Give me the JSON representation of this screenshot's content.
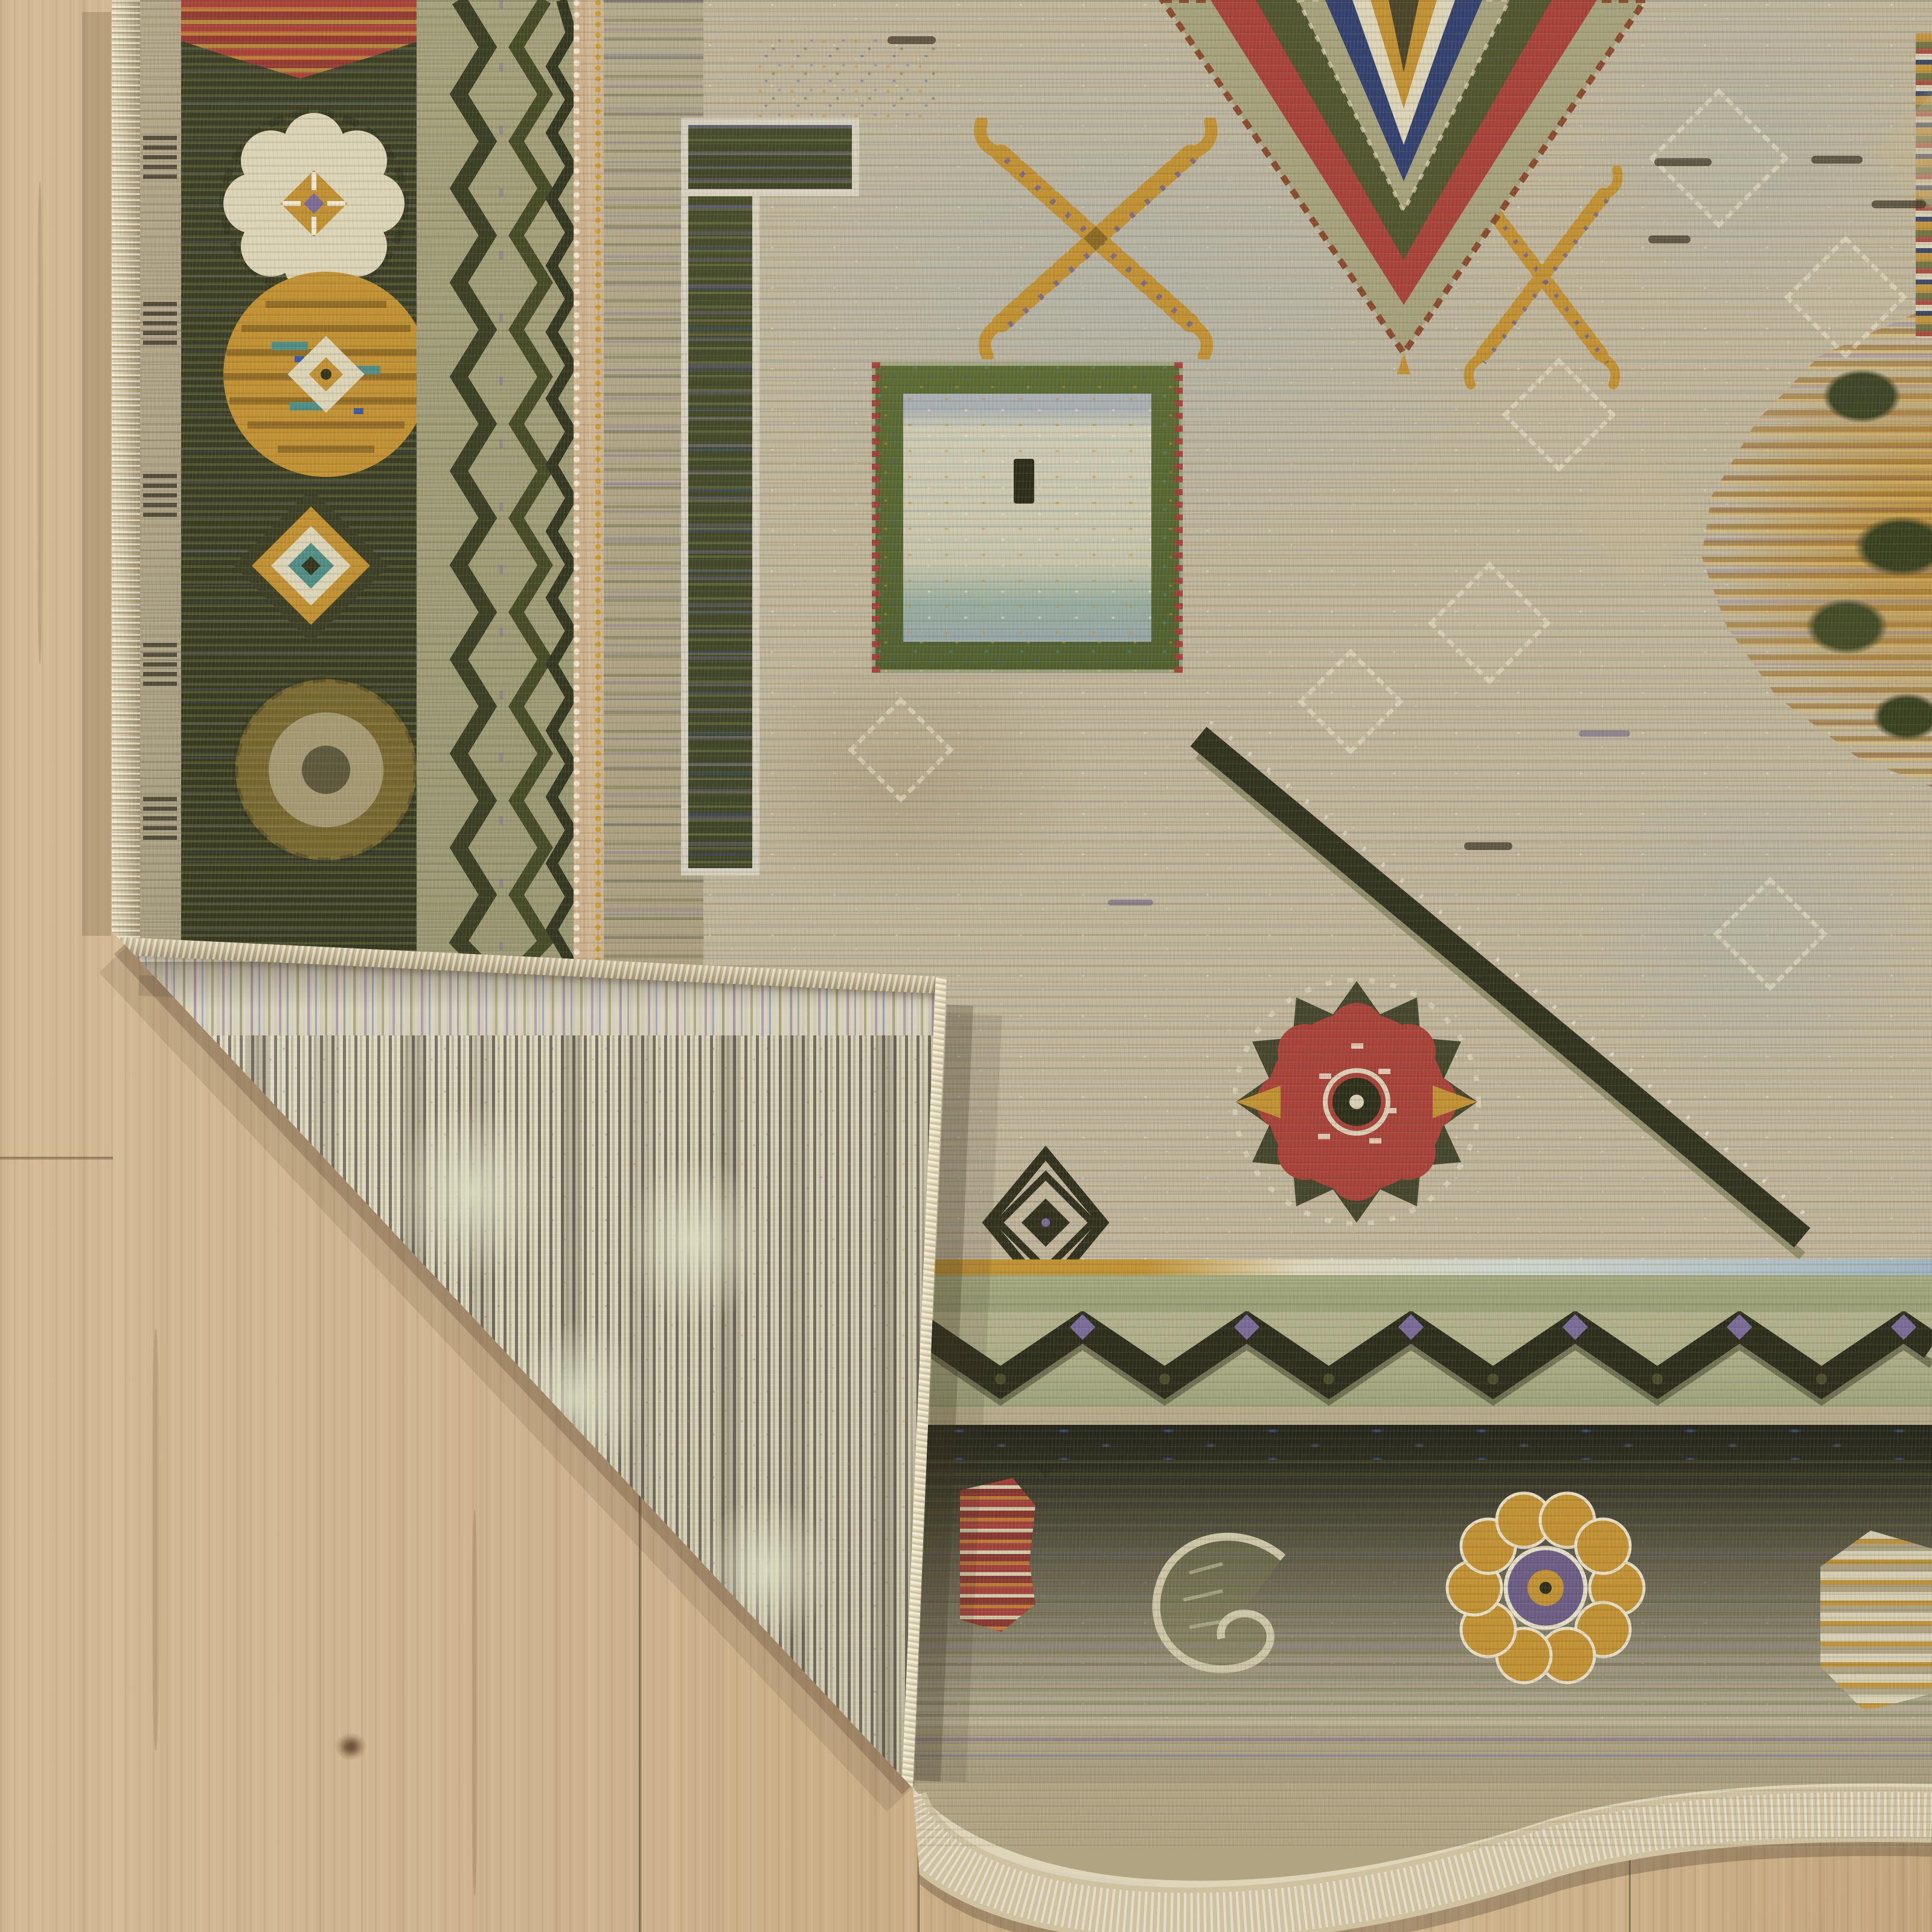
{
  "meta": {
    "type": "product-photo",
    "subject": "Area rug with folded-over corner revealing its woven backing, lying on a light oak wood floor",
    "no_visible_text": true
  },
  "palette": {
    "wood-base": "#cdb28d",
    "wood-light": "#dfcba6",
    "wood-dark": "#b1946f",
    "wood-seam": "#7e6748",
    "wood-knot": "#8a6f52",
    "bind": "#cfc2a0",
    "bind-light": "#e9dfbd",
    "bind-dark": "#a2936f",
    "back-base": "#dcd5c0",
    "back-rib": "#4a4332",
    "back-olive": "#6c7242",
    "back-cream": "#efe9d8",
    "field": "#c1b69b",
    "field-blue": "#a9b2b2",
    "field-tan": "#b4a685",
    "sage": "#a6a27c",
    "sage-light": "#b4b48d",
    "border-dark": "#3b3e25",
    "band-dark": "#28281b",
    "ink": "#2c2e1c",
    "cream": "#ddd5b8",
    "gold": "#c29132",
    "gold-deep": "#9a7322",
    "red": "#a84138",
    "rust": "#a8502f",
    "teal": "#4f8e85",
    "purple": "#7a6b98",
    "navy": "#32406e",
    "blue": "#3c58a2",
    "olive": "#5c6134"
  },
  "scene": {
    "label": "Photo of a multicolor tribal area rug on a wood floor with one corner folded over",
    "floor": {
      "label": "light oak laminate floor with vertical grain and plank seams"
    },
    "rug": {
      "label": "beige tribal rug: dark olive rosette border, zigzag guards, stone field with gold X motifs, stepped diamond medallions, red star, chevron band and dark floral band"
    },
    "fold": {
      "label": "folded corner showing cream ribbed woven backing with tan serged binding"
    }
  }
}
